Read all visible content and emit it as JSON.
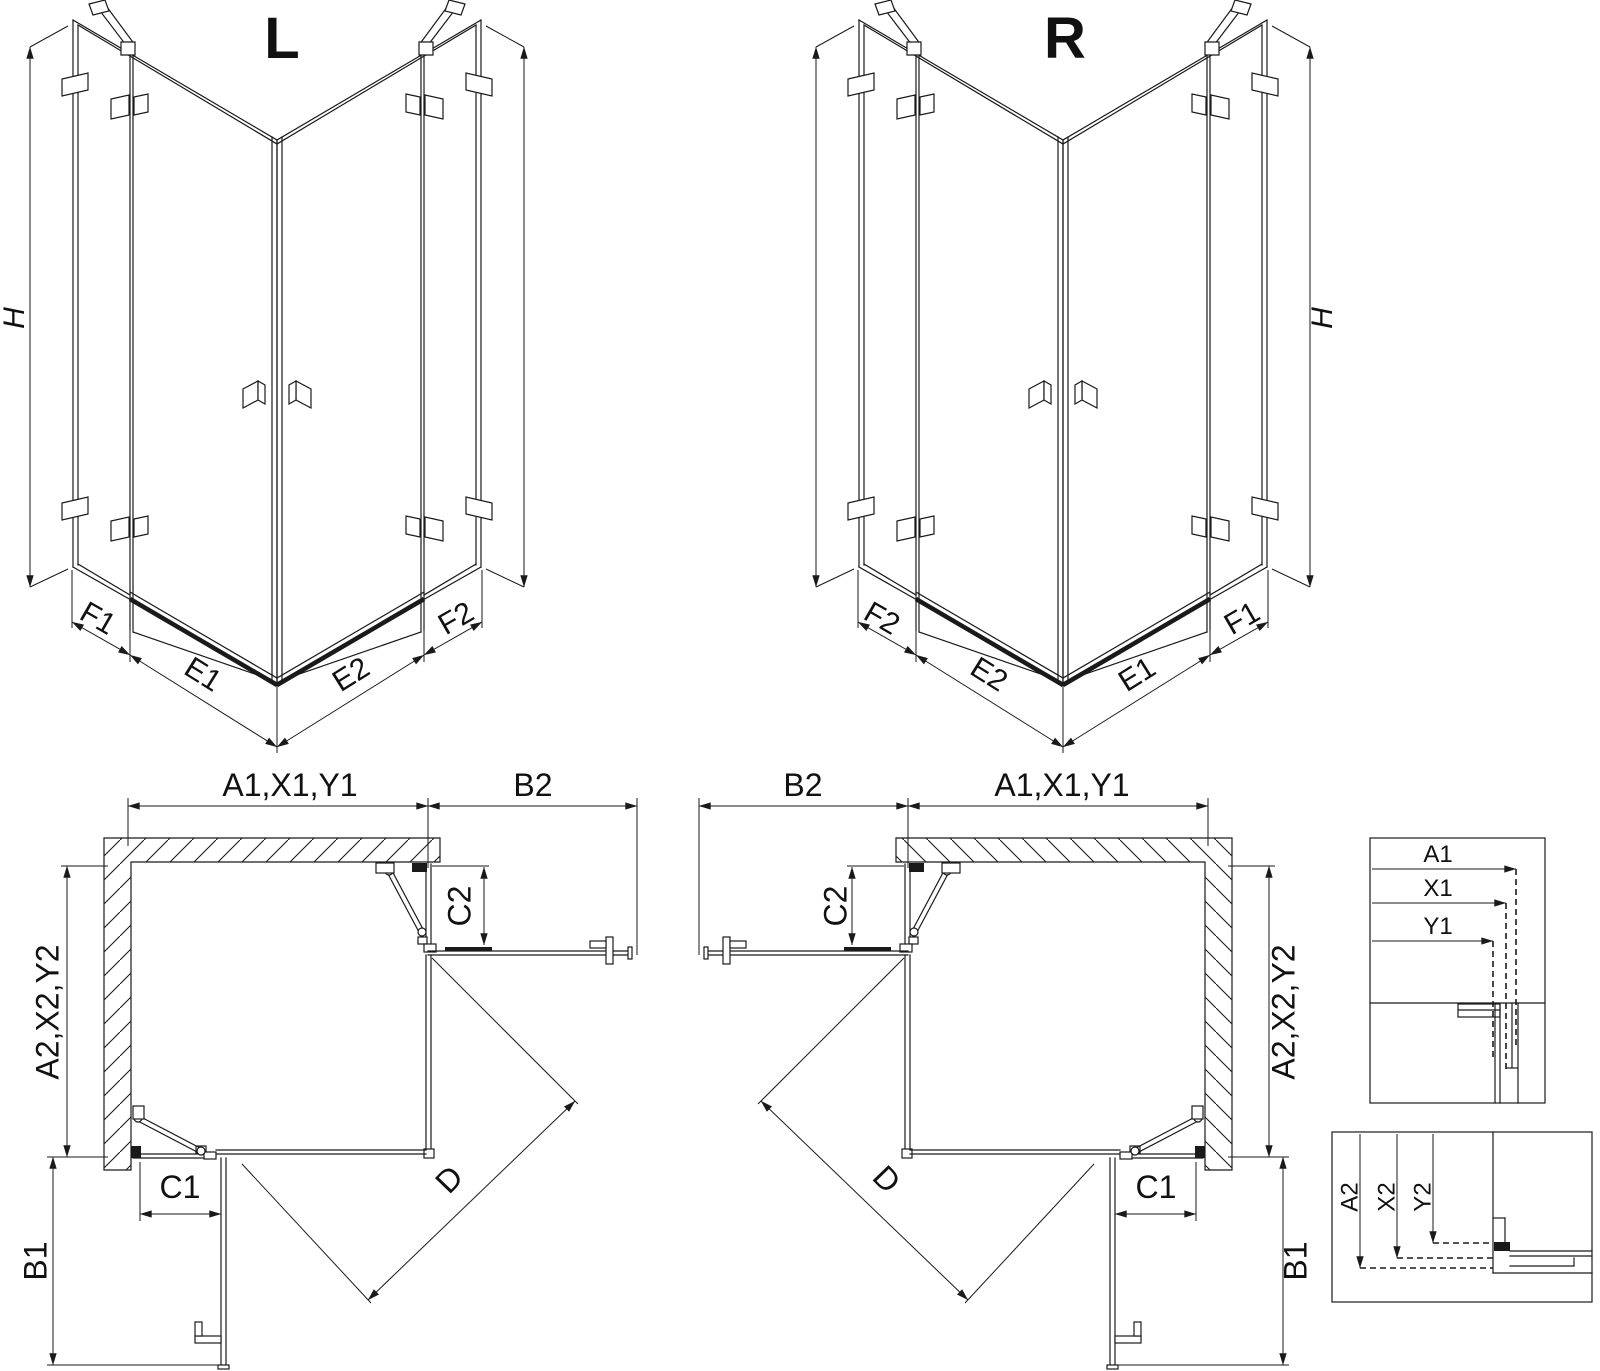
{
  "diagram": {
    "background": "#ffffff",
    "line_color": "#1a1a1a",
    "perspective_left": {
      "title": "L",
      "h": "H",
      "f1": "F1",
      "e1": "E1",
      "e2": "E2",
      "f2": "F2"
    },
    "perspective_right": {
      "title": "R",
      "h": "H",
      "f1": "F1",
      "e1": "E1",
      "e2": "E2",
      "f2": "F2"
    },
    "plan_left": {
      "width_top": "A1,X1,Y1",
      "door_top": "B2",
      "c2": "C2",
      "depth_side": "A2,X2,Y2",
      "c1": "C1",
      "b1": "B1",
      "diagonal": "D"
    },
    "plan_right": {
      "width_top": "A1,X1,Y1",
      "door_top": "B2",
      "c2": "C2",
      "depth_side": "A2,X2,Y2",
      "c1": "C1",
      "b1": "B1",
      "diagonal": "D"
    },
    "detail_top": {
      "a1": "A1",
      "x1": "X1",
      "y1": "Y1"
    },
    "detail_bottom": {
      "a2": "A2",
      "x2": "X2",
      "y2": "Y2"
    }
  }
}
